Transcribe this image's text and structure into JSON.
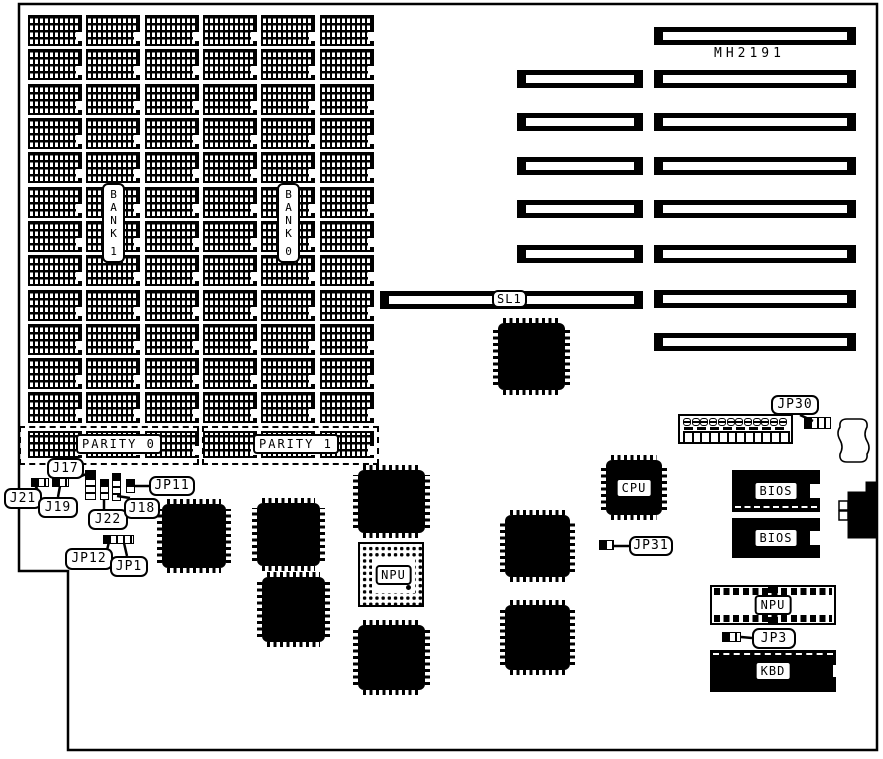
{
  "diagram": {
    "title": "MH2191 system board jumper diagram",
    "foreground": "#000000",
    "background": "#ffffff"
  },
  "memory": {
    "bank_labels": [
      {
        "text": "BANK 1"
      },
      {
        "text": "BANK 0"
      }
    ],
    "parity_labels": [
      {
        "text": "PARITY 0"
      },
      {
        "text": "PARITY 1"
      }
    ],
    "grid": {
      "col_xs": [
        28,
        86,
        145,
        203,
        261,
        320
      ],
      "chip_w": 54,
      "row_ys": [
        15,
        49,
        84,
        118,
        152,
        187,
        221,
        255,
        290,
        324,
        358,
        392
      ],
      "chip_h": 31,
      "parity_y": 431,
      "parity_h": 27
    },
    "parity_boxes": [
      {
        "x": 19,
        "y": 426,
        "w": 180,
        "h": 39
      },
      {
        "x": 202,
        "y": 426,
        "w": 177,
        "h": 39
      }
    ]
  },
  "slots": {
    "model_label": {
      "text": "MH2191"
    },
    "right": {
      "x": 654,
      "w": 202,
      "h": 18,
      "ys": [
        27,
        70,
        113,
        157,
        200,
        245,
        290,
        333
      ]
    },
    "left": {
      "x": 517,
      "w": 126,
      "h": 18,
      "ys": [
        70,
        113,
        157,
        200,
        245
      ]
    },
    "sl1": {
      "x": 380,
      "y": 291,
      "w": 263,
      "h": 18,
      "label": "SL1"
    }
  },
  "qfp_chips": [
    {
      "x": 162,
      "y": 504,
      "w": 64,
      "h": 64
    },
    {
      "x": 257,
      "y": 503,
      "w": 63,
      "h": 63
    },
    {
      "x": 262,
      "y": 577,
      "w": 63,
      "h": 65
    },
    {
      "x": 358,
      "y": 470,
      "w": 67,
      "h": 63
    },
    {
      "x": 358,
      "y": 625,
      "w": 67,
      "h": 65
    },
    {
      "x": 498,
      "y": 323,
      "w": 67,
      "h": 67
    },
    {
      "x": 505,
      "y": 515,
      "w": 65,
      "h": 62
    },
    {
      "x": 505,
      "y": 605,
      "w": 65,
      "h": 65
    },
    {
      "x": 606,
      "y": 460,
      "w": 56,
      "h": 55,
      "label": "CPU"
    }
  ],
  "pga_socket": {
    "x": 358,
    "y": 542,
    "w": 66,
    "h": 65,
    "label": "NPU"
  },
  "right_area": {
    "header_block": {
      "x": 678,
      "y": 414,
      "w": 115,
      "h": 30,
      "ovals": 12,
      "squares": 12
    },
    "battery": {
      "x": 838,
      "y": 418,
      "w": 32,
      "h": 46
    },
    "bios_chips": [
      {
        "x": 732,
        "y": 470,
        "w": 88,
        "h": 42,
        "label": "BIOS",
        "dashed": "bottom"
      },
      {
        "x": 732,
        "y": 518,
        "w": 88,
        "h": 40,
        "label": "BIOS",
        "dashed": "none"
      }
    ],
    "npu_socket": {
      "x": 710,
      "y": 585,
      "w": 126,
      "h": 40,
      "label": "NPU"
    },
    "kbd_chip": {
      "x": 710,
      "y": 650,
      "w": 126,
      "h": 42,
      "label": "KBD"
    },
    "kbd_connector": {
      "points": "848,492 866,492 866,482 877,482 877,538 848,538",
      "pins": [
        {
          "x": 839,
          "y": 501,
          "w": 9,
          "h": 9
        },
        {
          "x": 839,
          "y": 511,
          "w": 9,
          "h": 9
        }
      ]
    }
  },
  "jumpers": [
    {
      "id": "J17",
      "x": 85,
      "y": 470,
      "w": 11,
      "h": 30,
      "dir": "v"
    },
    {
      "id": "J21",
      "x": 31,
      "y": 478,
      "w": 18,
      "h": 9,
      "dir": "h"
    },
    {
      "id": "J19",
      "x": 52,
      "y": 478,
      "w": 17,
      "h": 9,
      "dir": "h"
    },
    {
      "id": "J22",
      "x": 100,
      "y": 479,
      "w": 9,
      "h": 21,
      "dir": "v"
    },
    {
      "id": "J18",
      "x": 112,
      "y": 473,
      "w": 9,
      "h": 28,
      "dir": "v"
    },
    {
      "id": "JP11",
      "x": 126,
      "y": 479,
      "w": 9,
      "h": 14,
      "dir": "v"
    },
    {
      "id": "JP12-JP1",
      "x": 103,
      "y": 535,
      "w": 31,
      "h": 9,
      "dir": "h"
    },
    {
      "id": "JP30",
      "x": 804,
      "y": 417,
      "w": 27,
      "h": 12,
      "dir": "h"
    },
    {
      "id": "JP31",
      "x": 599,
      "y": 540,
      "w": 15,
      "h": 10,
      "dir": "h"
    },
    {
      "id": "JP3",
      "x": 722,
      "y": 632,
      "w": 19,
      "h": 10,
      "dir": "h"
    }
  ],
  "callouts": [
    {
      "label": "J17",
      "x": 47,
      "y": 458,
      "w": 37,
      "h": 21,
      "line": [
        79,
        477,
        89,
        473
      ]
    },
    {
      "label": "J21",
      "x": 4,
      "y": 488,
      "w": 38,
      "h": 21,
      "line": [
        40,
        494,
        35,
        485
      ]
    },
    {
      "label": "J19",
      "x": 38,
      "y": 497,
      "w": 40,
      "h": 21,
      "line": [
        58,
        497,
        60,
        486
      ]
    },
    {
      "label": "J22",
      "x": 88,
      "y": 509,
      "w": 40,
      "h": 21,
      "line": [
        104,
        509,
        104,
        499
      ]
    },
    {
      "label": "J18",
      "x": 124,
      "y": 498,
      "w": 36,
      "h": 21,
      "line": [
        130,
        498,
        117,
        496
      ]
    },
    {
      "label": "JP11",
      "x": 149,
      "y": 476,
      "w": 46,
      "h": 20,
      "line": [
        149,
        486,
        135,
        486
      ]
    },
    {
      "label": "JP12",
      "x": 65,
      "y": 548,
      "w": 48,
      "h": 22,
      "line": [
        107,
        550,
        109,
        542
      ]
    },
    {
      "label": "JP1",
      "x": 110,
      "y": 556,
      "w": 38,
      "h": 21,
      "line": [
        127,
        556,
        124,
        543
      ]
    },
    {
      "label": "JP30",
      "x": 771,
      "y": 395,
      "w": 48,
      "h": 20,
      "line": [
        800,
        415,
        813,
        421
      ]
    },
    {
      "label": "JP31",
      "x": 629,
      "y": 536,
      "w": 44,
      "h": 20,
      "line": [
        629,
        546,
        614,
        546
      ]
    },
    {
      "label": "JP3",
      "x": 752,
      "y": 628,
      "w": 44,
      "h": 21,
      "line": [
        752,
        638,
        741,
        637
      ]
    }
  ],
  "board_outline": {
    "points": "19,4 877,4 877,750 68,750 68,571 19,571"
  },
  "battery_path": "M 847 419 L 860 419 Q 868 419 867 427 Q 863 434 867 441 Q 871 448 867 454 Q 868 462 860 462 L 847 462 Q 839 462 840 454 Q 844 447 840 440 Q 836 433 840 427 Q 839 419 847 419 Z"
}
